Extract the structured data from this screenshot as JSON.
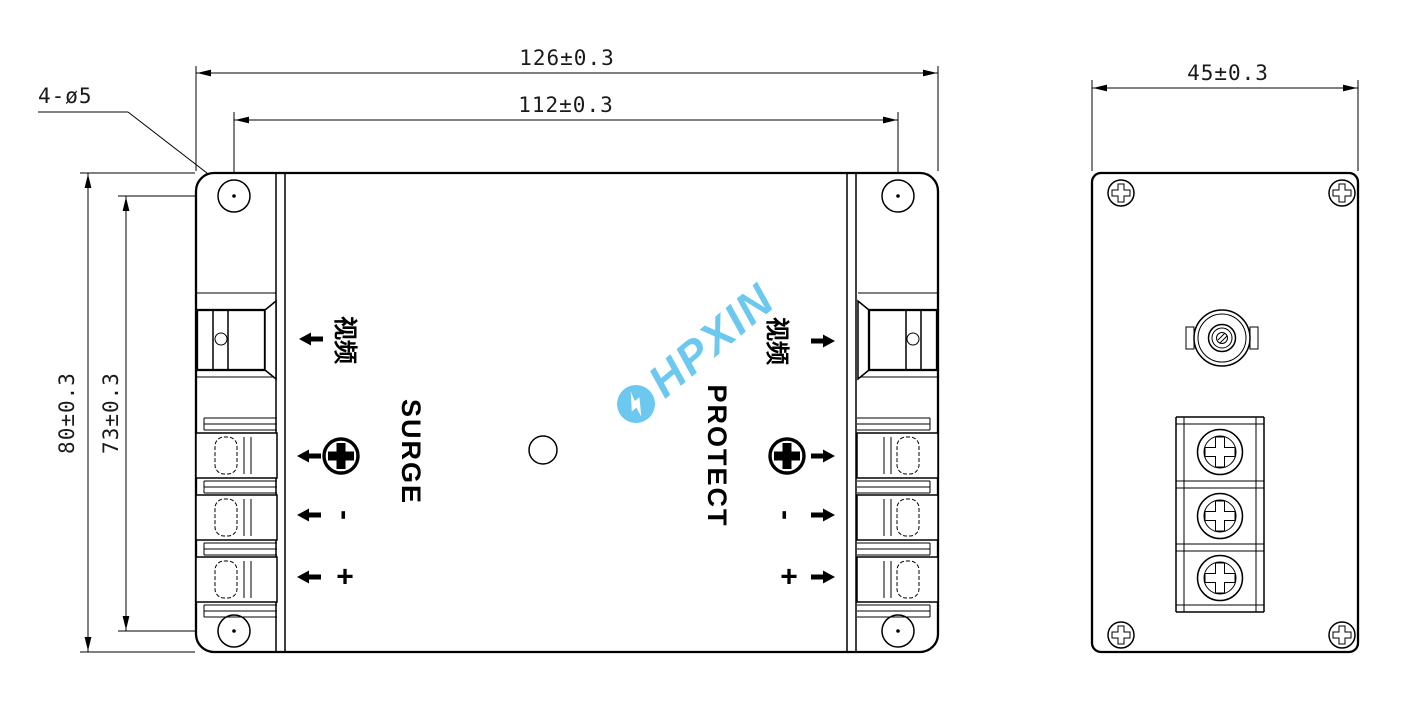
{
  "watermark": {
    "brand": "HPXIN"
  },
  "colors": {
    "watermark_blue": "#53bfee",
    "line_black": "#000000"
  },
  "front_view": {
    "dim_overall_width": "126±0.3",
    "dim_hole_span_width": "112±0.3",
    "dim_overall_height": "80±0.3",
    "dim_hole_span_height": "73±0.3",
    "dim_hole_callout": "4-ø5",
    "label_surge": "SURGE",
    "label_protect": "PROTECT",
    "label_video_in": "视频",
    "label_video_out": "视频",
    "label_minus_in": "-",
    "label_plus_in": "+",
    "label_minus_out": "-",
    "label_plus_out": "+"
  },
  "side_view": {
    "dim_overall_depth": "45±0.3"
  }
}
